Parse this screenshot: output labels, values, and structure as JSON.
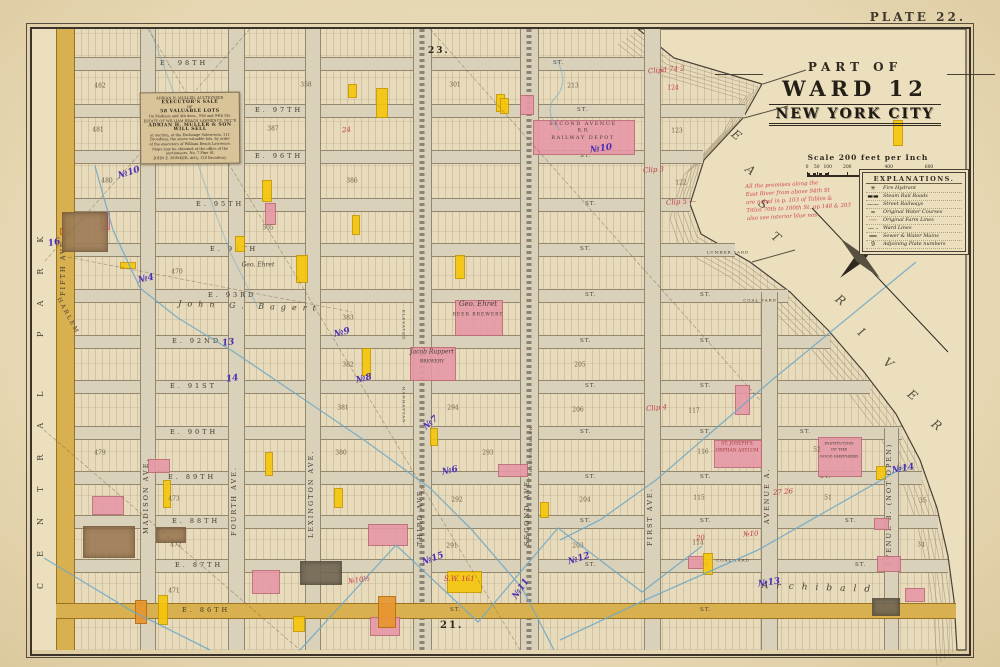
{
  "plate": "PLATE 22.",
  "park_label": "CENTRAL PARK",
  "adjoining": {
    "top": "23.",
    "bottom": "21."
  },
  "title": {
    "lines": [
      "PART OF",
      "WARD 12",
      "NEW YORK CITY"
    ]
  },
  "scale": {
    "title": "Scale 200 feet per Inch",
    "ticks": [
      [
        "0",
        0
      ],
      [
        "50",
        8
      ],
      [
        "100",
        17
      ],
      [
        "200",
        33
      ],
      [
        "400",
        67
      ],
      [
        "600",
        100
      ]
    ]
  },
  "legend": {
    "title": "EXPLANATIONS.",
    "items": [
      {
        "glyph": "✳",
        "label": "Fire Hydrant"
      },
      {
        "glyph": "▬▬",
        "label": "Steam Rail Roads"
      },
      {
        "glyph": "——",
        "label": "Street Railways"
      },
      {
        "glyph": "≈",
        "label": "Original Water Courses"
      },
      {
        "glyph": "┈┈",
        "label": "Original Farm Lines"
      },
      {
        "glyph": "— -",
        "label": "Ward Lines"
      },
      {
        "glyph": "══",
        "label": "Sewer & Water Mains"
      },
      {
        "glyph": "9",
        "label": "Adjoining Plate numbers"
      }
    ]
  },
  "ad": {
    "lines": [
      {
        "t": "ADRIAN H. MULLER, AUCTIONEER",
        "b": false
      },
      {
        "t": "EXECUTOR'S SALE",
        "b": true
      },
      {
        "t": "OF",
        "b": false
      },
      {
        "t": "58 VALUABLE LOTS",
        "b": true
      },
      {
        "t": "On Madison and 4th Aves., 93d and 94th Sts.",
        "b": false
      },
      {
        "t": "ESTATE OF WILLIAM BEACH LAWRENCE, DEC'D",
        "b": false
      },
      {
        "t": "ADRIAN H. MULLER & SON WILL SELL",
        "b": true
      },
      {
        "t": "at auction, at the Exchange Salesroom, 111",
        "b": false
      },
      {
        "t": "Broadway, the above valuable lots, by order",
        "b": false
      },
      {
        "t": "of the executors of William Beach Lawrence.",
        "b": false
      },
      {
        "t": "Maps may be obtained at the office of the",
        "b": false
      },
      {
        "t": "auctioneers, No. 7 Pine St.",
        "b": false
      },
      {
        "t": "JOHN E. BOWKER, Att'y, 120 Broadway.",
        "b": false
      }
    ]
  },
  "red_note": {
    "lines": [
      "All the premises along the",
      "East River from above 94th St",
      "are noted in p. 103 of Tables &",
      "Titles 70th to 100th St. pp 148 & 203",
      "also see interior blue nos."
    ]
  },
  "map": {
    "st_abbr": "ST.",
    "streets": [
      {
        "label": "E. 98TH",
        "y": 63,
        "lx": 160,
        "x1": 645,
        "st": [
          553
        ]
      },
      {
        "label": "E. 97TH",
        "y": 110,
        "lx": 255,
        "x1": 745,
        "st": [
          577
        ]
      },
      {
        "label": "E. 96TH",
        "y": 156,
        "lx": 255,
        "x1": 703,
        "st": [
          580
        ]
      },
      {
        "label": "E. 95TH",
        "y": 204,
        "lx": 196,
        "x1": 690,
        "st": [
          585
        ]
      },
      {
        "label": "E. 94TH",
        "y": 249,
        "lx": 210,
        "x1": 735,
        "st": [
          580
        ]
      },
      {
        "label": "E. 93RD",
        "y": 295,
        "lx": 208,
        "x1": 788,
        "st": [
          585,
          700
        ]
      },
      {
        "label": "E. 92ND",
        "y": 341,
        "lx": 172,
        "x1": 830,
        "st": [
          580,
          700
        ]
      },
      {
        "label": "E. 91ST",
        "y": 386,
        "lx": 170,
        "x1": 870,
        "st": [
          585,
          700
        ]
      },
      {
        "label": "E. 90TH",
        "y": 432,
        "lx": 170,
        "x1": 902,
        "st": [
          580,
          700,
          800
        ]
      },
      {
        "label": "E. 89TH",
        "y": 477,
        "lx": 168,
        "x1": 922,
        "st": [
          585,
          700,
          820
        ]
      },
      {
        "label": "E. 88TH",
        "y": 521,
        "lx": 172,
        "x1": 938,
        "st": [
          580,
          700,
          845
        ]
      },
      {
        "label": "E. 87TH",
        "y": 565,
        "lx": 175,
        "x1": 948,
        "st": [
          585,
          700,
          855
        ]
      },
      {
        "label": "E. 86TH",
        "y": 610,
        "lx": 182,
        "x1": 956,
        "yellow": true,
        "st": [
          450,
          700
        ]
      }
    ],
    "avenues": [
      {
        "label": "FIFTH AVE.",
        "x": 64,
        "y0": 29,
        "y1": 650,
        "w": 17,
        "yellow": true,
        "ly": 250
      },
      {
        "label": "MADISON AVE.",
        "x": 147,
        "y0": 29,
        "y1": 650,
        "w": 14,
        "ly": 488
      },
      {
        "label": "FOURTH AVE.",
        "x": 235,
        "y0": 29,
        "y1": 650,
        "w": 15,
        "ly": 490
      },
      {
        "label": "LEXINGTON AVE.",
        "x": 312,
        "y0": 29,
        "y1": 650,
        "w": 14,
        "ly": 492
      },
      {
        "label": "THIRD AVE.",
        "x": 421,
        "y0": 29,
        "y1": 650,
        "w": 17,
        "el": true,
        "ly": 500
      },
      {
        "label": "SECOND AVE.",
        "x": 528,
        "y0": 29,
        "y1": 650,
        "w": 17,
        "el": true,
        "ly": 500
      },
      {
        "label": "FIRST AVE.",
        "x": 651,
        "y0": 29,
        "y1": 650,
        "w": 15,
        "ly": 500
      },
      {
        "label": "AVENUE A.",
        "x": 768,
        "y0": 292,
        "y1": 650,
        "w": 15,
        "ly": 478
      },
      {
        "label": "AVENUE B. (NOT OPEN)",
        "x": 890,
        "y0": 428,
        "y1": 650,
        "w": 13,
        "ly": 520
      }
    ],
    "block_numbers": [
      [
        "482",
        100,
        86
      ],
      [
        "358",
        306,
        85
      ],
      [
        "301",
        455,
        85
      ],
      [
        "213",
        573,
        86
      ],
      [
        "124",
        673,
        88,
        true
      ],
      [
        "123",
        677,
        131
      ],
      [
        "122",
        681,
        183
      ],
      [
        "481",
        98,
        130
      ],
      [
        "387",
        273,
        129
      ],
      [
        "480",
        107,
        181
      ],
      [
        "386",
        352,
        181
      ],
      [
        "505",
        268,
        228
      ],
      [
        "470",
        177,
        272
      ],
      [
        "479",
        100,
        453
      ],
      [
        "473",
        174,
        499
      ],
      [
        "472",
        176,
        545
      ],
      [
        "471",
        174,
        591
      ],
      [
        "383",
        348,
        318
      ],
      [
        "382",
        348,
        365
      ],
      [
        "381",
        343,
        408
      ],
      [
        "380",
        341,
        453
      ],
      [
        "294",
        453,
        408
      ],
      [
        "293",
        488,
        453
      ],
      [
        "292",
        457,
        500
      ],
      [
        "291",
        452,
        546
      ],
      [
        "205",
        580,
        365
      ],
      [
        "206",
        578,
        410
      ],
      [
        "204",
        585,
        500
      ],
      [
        "203",
        578,
        546
      ],
      [
        "117",
        694,
        411
      ],
      [
        "116",
        703,
        452
      ],
      [
        "115",
        699,
        498
      ],
      [
        "114",
        698,
        543
      ],
      [
        "52",
        817,
        450
      ],
      [
        "51",
        828,
        498
      ],
      [
        "35",
        923,
        501
      ],
      [
        "34",
        921,
        545
      ]
    ],
    "buildings": [
      [
        533,
        120,
        100,
        33,
        "p"
      ],
      [
        455,
        300,
        46,
        34,
        "p"
      ],
      [
        410,
        347,
        44,
        32,
        "p"
      ],
      [
        714,
        440,
        46,
        26,
        "p"
      ],
      [
        818,
        437,
        42,
        38,
        "p"
      ],
      [
        92,
        496,
        30,
        17,
        "p"
      ],
      [
        148,
        459,
        20,
        12,
        "p"
      ],
      [
        265,
        203,
        9,
        20,
        "p"
      ],
      [
        368,
        524,
        38,
        20,
        "p"
      ],
      [
        252,
        570,
        26,
        22,
        "p"
      ],
      [
        498,
        464,
        28,
        11,
        "p"
      ],
      [
        735,
        385,
        13,
        28,
        "p"
      ],
      [
        874,
        518,
        13,
        10,
        "p"
      ],
      [
        877,
        556,
        22,
        14,
        "p"
      ],
      [
        688,
        556,
        14,
        11,
        "p"
      ],
      [
        370,
        617,
        28,
        17,
        "p"
      ],
      [
        520,
        95,
        12,
        18,
        "p"
      ],
      [
        905,
        588,
        18,
        12,
        "p"
      ],
      [
        100,
        212,
        8,
        16,
        "p"
      ],
      [
        376,
        88,
        10,
        28,
        "y"
      ],
      [
        348,
        84,
        7,
        12,
        "y"
      ],
      [
        496,
        94,
        7,
        16,
        "y"
      ],
      [
        893,
        120,
        8,
        24,
        "y"
      ],
      [
        262,
        180,
        8,
        20,
        "y"
      ],
      [
        235,
        236,
        8,
        14,
        "y"
      ],
      [
        296,
        255,
        10,
        26,
        "y"
      ],
      [
        455,
        255,
        8,
        22,
        "y"
      ],
      [
        362,
        348,
        7,
        26,
        "y"
      ],
      [
        352,
        215,
        6,
        18,
        "y"
      ],
      [
        265,
        452,
        6,
        22,
        "y"
      ],
      [
        163,
        480,
        6,
        26,
        "y"
      ],
      [
        334,
        488,
        7,
        18,
        "y"
      ],
      [
        430,
        428,
        6,
        16,
        "y"
      ],
      [
        540,
        502,
        7,
        14,
        "y"
      ],
      [
        703,
        553,
        8,
        20,
        "y"
      ],
      [
        876,
        466,
        8,
        12,
        "y"
      ],
      [
        158,
        595,
        8,
        28,
        "y"
      ],
      [
        447,
        571,
        33,
        20,
        "y"
      ],
      [
        293,
        616,
        10,
        14,
        "y"
      ],
      [
        500,
        98,
        7,
        14,
        "y"
      ],
      [
        120,
        262,
        14,
        5,
        "y"
      ],
      [
        378,
        596,
        16,
        30,
        "o"
      ],
      [
        60,
        228,
        9,
        5,
        "o"
      ],
      [
        135,
        600,
        10,
        22,
        "o"
      ],
      [
        62,
        212,
        44,
        38,
        "b"
      ],
      [
        83,
        526,
        50,
        30,
        "b"
      ],
      [
        156,
        527,
        28,
        14,
        "b"
      ],
      [
        300,
        561,
        40,
        22,
        "d"
      ],
      [
        872,
        598,
        26,
        16,
        "d"
      ]
    ],
    "texts": [
      {
        "t": "SECOND AVENUE",
        "x": 583,
        "y": 124,
        "s": 5,
        "ls": 1.5
      },
      {
        "t": "R. R.",
        "x": 583,
        "y": 131,
        "s": 4.5
      },
      {
        "t": "RAILWAY DEPOT",
        "x": 583,
        "y": 138,
        "s": 5,
        "ls": 1.5
      },
      {
        "t": "Geo. Ehret",
        "x": 478,
        "y": 304,
        "s": 7,
        "i": true
      },
      {
        "t": "BEER BREWERY",
        "x": 478,
        "y": 315,
        "s": 4.5,
        "ls": 1
      },
      {
        "t": "Jacob Ruppert",
        "x": 432,
        "y": 352,
        "s": 6,
        "i": true
      },
      {
        "t": "BREWERY",
        "x": 432,
        "y": 362,
        "s": 4.5
      },
      {
        "t": "ST. JOSEPH'S",
        "x": 737,
        "y": 444,
        "s": 4.5,
        "c": "#a23b3b"
      },
      {
        "t": "ORPHAN ASYLUM",
        "x": 737,
        "y": 451,
        "s": 4.5,
        "c": "#a23b3b"
      },
      {
        "t": "INSTITUTION",
        "x": 839,
        "y": 443,
        "s": 4
      },
      {
        "t": "OF THE",
        "x": 839,
        "y": 449,
        "s": 4
      },
      {
        "t": "GOOD SHEPHERD",
        "x": 839,
        "y": 456,
        "s": 4
      },
      {
        "t": "LUMBER YARD",
        "x": 728,
        "y": 252,
        "s": 4,
        "ls": 1
      },
      {
        "t": "COAL YARD",
        "x": 760,
        "y": 300,
        "s": 4,
        "ls": 1
      },
      {
        "t": "COAL YARD",
        "x": 733,
        "y": 560,
        "s": 4,
        "ls": 1
      },
      {
        "t": "Geo. Ehret",
        "x": 258,
        "y": 265,
        "s": 6,
        "i": true
      },
      {
        "t": "John G. Bagert",
        "x": 250,
        "y": 306,
        "s": 8,
        "i": true,
        "ls": 6,
        "r": 2
      },
      {
        "t": "Archibald",
        "x": 820,
        "y": 588,
        "s": 9,
        "i": true,
        "ls": 8,
        "r": 2
      },
      {
        "t": "HARLEM",
        "x": 68,
        "y": 316,
        "s": 6,
        "r": 62,
        "ls": 2
      },
      {
        "t": "MANHATTAN",
        "x": 404,
        "y": 405,
        "s": 4,
        "r": 90,
        "ls": 1
      },
      {
        "t": "ELEVATED",
        "x": 404,
        "y": 325,
        "s": 4,
        "r": 90,
        "ls": 1
      },
      {
        "t": "METROPOLITAN",
        "x": 531,
        "y": 450,
        "s": 4,
        "r": 90,
        "ls": 1
      }
    ],
    "river": {
      "name": "EAST RIVER",
      "letters": [
        [
          "E",
          732,
          128
        ],
        [
          "A",
          746,
          163
        ],
        [
          "S",
          759,
          197
        ],
        [
          "T",
          772,
          230
        ],
        [
          "R",
          836,
          293
        ],
        [
          "I",
          859,
          325
        ],
        [
          "V",
          884,
          356
        ],
        [
          "E",
          908,
          388
        ],
        [
          "R",
          932,
          418
        ]
      ]
    },
    "purple_notes": [
      [
        "№10",
        118,
        168,
        -18
      ],
      [
        "16",
        48,
        238,
        -12
      ],
      [
        "№4",
        138,
        274,
        -12
      ],
      [
        "13",
        222,
        338,
        -8
      ],
      [
        "14",
        226,
        374,
        -8
      ],
      [
        "№9",
        334,
        328,
        -14
      ],
      [
        "№8",
        356,
        374,
        -14
      ],
      [
        "№7",
        423,
        418,
        -40
      ],
      [
        "№6",
        442,
        466,
        -12
      ],
      [
        "№15",
        422,
        554,
        -20
      ],
      [
        "№11",
        510,
        584,
        -55
      ],
      [
        "№12",
        568,
        554,
        -18
      ],
      [
        "№14",
        892,
        464,
        -10
      ],
      [
        "№13",
        758,
        578,
        -8
      ],
      [
        "№10",
        590,
        144,
        -8
      ]
    ],
    "red_marks": [
      [
        "Clipd 74 2",
        648,
        66,
        -4
      ],
      [
        "Clip 3",
        643,
        166,
        -3
      ],
      [
        "Clip 5 —",
        666,
        198,
        -3
      ],
      [
        "24",
        342,
        126,
        -5
      ],
      [
        "Clip 4",
        646,
        404,
        -5
      ],
      [
        "27  26",
        773,
        488,
        -5
      ],
      [
        "20",
        696,
        534,
        -5
      ],
      [
        "№10",
        743,
        530,
        -5
      ],
      [
        "№10½",
        348,
        576,
        -8
      ],
      [
        "S.W. 161",
        444,
        575,
        0
      ]
    ]
  }
}
